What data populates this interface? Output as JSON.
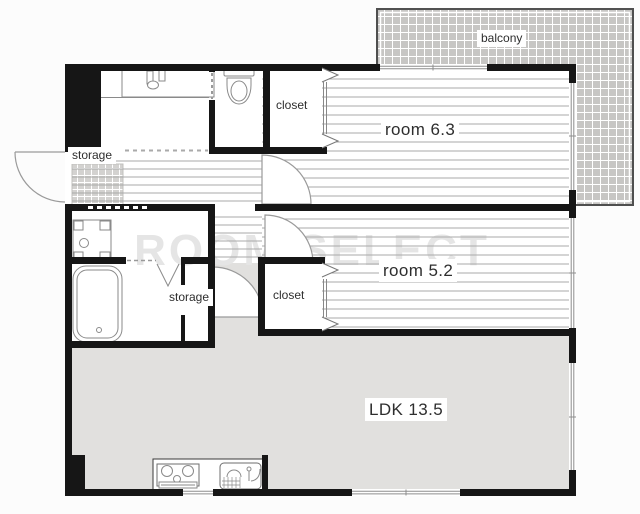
{
  "plan_title": "apartment floor plan",
  "watermark": "ROOM SELECT",
  "rooms": {
    "balcony": {
      "label": "balcony"
    },
    "closet_top": {
      "label": "closet"
    },
    "entry_storage": {
      "label": "storage"
    },
    "inner_storage": {
      "label": "storage"
    },
    "closet_mid": {
      "label": "closet"
    },
    "bedroom_top": {
      "label": "room 6.3",
      "area": 6.3
    },
    "bedroom_mid": {
      "label": "room 5.2",
      "area": 5.2
    },
    "ldk": {
      "label": "LDK 13.5",
      "area": 13.5
    }
  },
  "fixtures": [
    "vanity-icon",
    "toilet-icon",
    "washing-machine-pan-icon",
    "bathtub-icon",
    "folding-door-icon",
    "stove-icon",
    "kitchen-sink-icon",
    "door-swing-icon",
    "sliding-door-chevron-icon"
  ],
  "colors": {
    "wall": "#161616",
    "ldk_floor": "#e1e0de",
    "balcony_fill": "#c7c6c4",
    "entrance_tile": "#d3d2d0",
    "floor_line": "#a9a9a9",
    "fixture_stroke": "#8a8a8a",
    "watermark": "#e5e5e5",
    "label_text": "#2e2e2e"
  }
}
